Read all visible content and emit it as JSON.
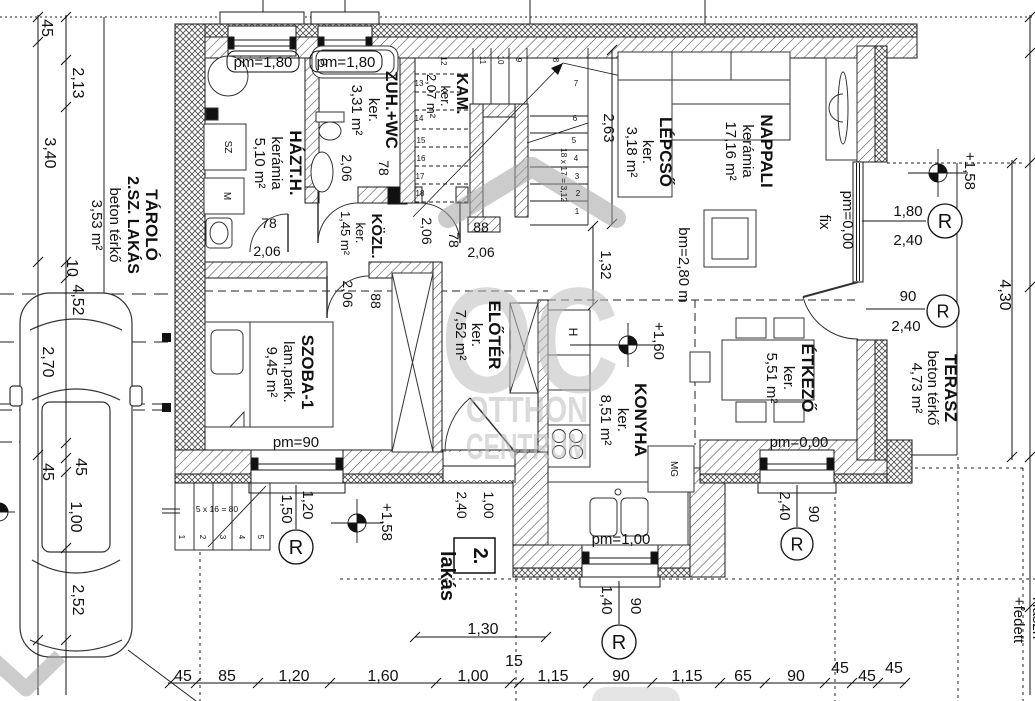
{
  "meta": {
    "drawing_type": "floor-plan",
    "unit_tag": "2. lakás",
    "background": "#ffffff",
    "line_color": "#111111",
    "watermark_color": "#bdbdbd"
  },
  "watermark": {
    "letters": "OC",
    "line1": "OTTHON",
    "line2": "CENTRUM"
  },
  "rooms": [
    {
      "name": "TÁROLÓ 2.SZ. LAKÁS",
      "finish": "beton térkő",
      "area": "3,53 m²"
    },
    {
      "name": "HÁZT.H.",
      "finish": "kerámia",
      "area": "5,10 m²"
    },
    {
      "name": "ZUH.+WC",
      "finish": "ker.",
      "area": "3,31 m²"
    },
    {
      "name": "KAM.",
      "finish": "ker.",
      "area": "2,07 m²"
    },
    {
      "name": "LÉPCSŐ",
      "finish": "ker.",
      "area": "3,18 m²"
    },
    {
      "name": "NAPPALI",
      "finish": "kerámia",
      "area": "17,16 m²"
    },
    {
      "name": "KÖZL.",
      "finish": "ker.",
      "area": "1,45 m²"
    },
    {
      "name": "SZOBA-1",
      "finish": "lam.park.",
      "area": "9,45 m²"
    },
    {
      "name": "ELŐTÉR",
      "finish": "ker.",
      "area": "7,52 m²"
    },
    {
      "name": "KONYHA",
      "finish": "ker.",
      "area": "8,51 m²"
    },
    {
      "name": "ÉTKEZŐ",
      "finish": "ker.",
      "area": "5,51 m²"
    },
    {
      "name": "TERASZ",
      "finish": "beton térkő",
      "area": "4,73 m²"
    }
  ],
  "r_letter": "R",
  "r_markers": [
    {
      "x": 945,
      "y": 221,
      "rad": 17
    },
    {
      "x": 943,
      "y": 311,
      "rad": 16
    },
    {
      "x": 296,
      "y": 547,
      "rad": 17
    },
    {
      "x": 619,
      "y": 642,
      "rad": 17
    },
    {
      "x": 797,
      "y": 544,
      "rad": 16
    }
  ],
  "elev_markers": [
    {
      "x": 938,
      "y": 173,
      "h1": 30,
      "h2": 30,
      "v1": 24,
      "v2": 24
    },
    {
      "x": 357,
      "y": 523,
      "h1": 26,
      "h2": 26,
      "v1": 24,
      "v2": 20
    },
    {
      "x": 628,
      "y": 345,
      "h1": 58,
      "h2": 28,
      "v1": 22,
      "v2": 22
    },
    {
      "x": -1,
      "y": 512,
      "h1": 0,
      "h2": 16,
      "v1": 12,
      "v2": 12
    }
  ],
  "labels": [
    {
      "t": "TÁROLÓ",
      "x": 146,
      "y": 225,
      "r": 90,
      "s": 17,
      "b": 1,
      "n": "room-label-tarolo"
    },
    {
      "t": "2.SZ. LAKÁS",
      "x": 128,
      "y": 225,
      "r": 90,
      "s": 16,
      "b": 1
    },
    {
      "t": "beton térkő",
      "x": 110,
      "y": 225,
      "r": 90,
      "s": 15
    },
    {
      "t": "3,53 m²",
      "x": 92,
      "y": 225,
      "r": 90,
      "s": 15
    },
    {
      "t": "HÁZT.H.",
      "x": 290,
      "y": 163,
      "r": 90,
      "s": 17,
      "b": 1,
      "n": "room-label-hazth"
    },
    {
      "t": "kerámia",
      "x": 272,
      "y": 163,
      "r": 90,
      "s": 15
    },
    {
      "t": "5,10 m²",
      "x": 255,
      "y": 163,
      "r": 90,
      "s": 15
    },
    {
      "t": "ZUH.+WC",
      "x": 386,
      "y": 110,
      "r": 90,
      "s": 17,
      "b": 1,
      "n": "room-label-zuhwc"
    },
    {
      "t": "ker.",
      "x": 369,
      "y": 110,
      "r": 90,
      "s": 15
    },
    {
      "t": "3,31 m²",
      "x": 352,
      "y": 110,
      "r": 90,
      "s": 15
    },
    {
      "t": "KAM.",
      "x": 457,
      "y": 94,
      "r": 90,
      "s": 16,
      "b": 1,
      "n": "room-label-kam"
    },
    {
      "t": "ker.",
      "x": 441,
      "y": 96,
      "r": 90,
      "s": 13
    },
    {
      "t": "2,07 m²",
      "x": 427,
      "y": 96,
      "r": 90,
      "s": 13
    },
    {
      "t": "LÉPCSŐ",
      "x": 660,
      "y": 152,
      "r": 90,
      "s": 17,
      "b": 1,
      "n": "room-label-lepcso"
    },
    {
      "t": "ker.",
      "x": 643,
      "y": 152,
      "r": 90,
      "s": 15
    },
    {
      "t": "3,18 m²",
      "x": 627,
      "y": 152,
      "r": 90,
      "s": 15
    },
    {
      "t": "NAPPALI",
      "x": 761,
      "y": 151,
      "r": 90,
      "s": 17,
      "b": 1,
      "n": "room-label-nappali"
    },
    {
      "t": "kerámia",
      "x": 743,
      "y": 151,
      "r": 90,
      "s": 15
    },
    {
      "t": "17,16 m²",
      "x": 726,
      "y": 151,
      "r": 90,
      "s": 15
    },
    {
      "t": "KÖZL.",
      "x": 372,
      "y": 236,
      "r": 90,
      "s": 15,
      "b": 1,
      "n": "room-label-kozl"
    },
    {
      "t": "ker.",
      "x": 356,
      "y": 233,
      "r": 90,
      "s": 13
    },
    {
      "t": "1,45 m²",
      "x": 341,
      "y": 233,
      "r": 90,
      "s": 13
    },
    {
      "t": "SZOBA-1",
      "x": 302,
      "y": 372,
      "r": 90,
      "s": 17,
      "b": 1,
      "n": "room-label-szoba1"
    },
    {
      "t": "lam.park.",
      "x": 284,
      "y": 372,
      "r": 90,
      "s": 15
    },
    {
      "t": "9,45 m²",
      "x": 267,
      "y": 372,
      "r": 90,
      "s": 15
    },
    {
      "t": "ELŐTÉR",
      "x": 489,
      "y": 335,
      "r": 90,
      "s": 17,
      "b": 1,
      "n": "room-label-eloter"
    },
    {
      "t": "ker.",
      "x": 472,
      "y": 335,
      "r": 90,
      "s": 15
    },
    {
      "t": "7,52 m²",
      "x": 456,
      "y": 335,
      "r": 90,
      "s": 15
    },
    {
      "t": "KONYHA",
      "x": 635,
      "y": 420,
      "r": 90,
      "s": 17,
      "b": 1,
      "n": "room-label-konyha"
    },
    {
      "t": "ker.",
      "x": 618,
      "y": 420,
      "r": 90,
      "s": 15
    },
    {
      "t": "8,51 m²",
      "x": 601,
      "y": 420,
      "r": 90,
      "s": 15
    },
    {
      "t": "ÉTKEZŐ",
      "x": 802,
      "y": 378,
      "r": 90,
      "s": 17,
      "b": 1,
      "n": "room-label-etkezo"
    },
    {
      "t": "ker.",
      "x": 784,
      "y": 378,
      "r": 90,
      "s": 15
    },
    {
      "t": "5,51 m²",
      "x": 767,
      "y": 378,
      "r": 90,
      "s": 15
    },
    {
      "t": "TERASZ",
      "x": 945,
      "y": 388,
      "r": 90,
      "s": 17,
      "b": 1,
      "n": "room-label-terasz"
    },
    {
      "t": "beton térkő",
      "x": 928,
      "y": 388,
      "r": 90,
      "s": 15
    },
    {
      "t": "4,73 m²",
      "x": 912,
      "y": 388,
      "r": 90,
      "s": 15
    },
    {
      "t": "pm=1,80",
      "x": 263,
      "y": 67,
      "s": 15,
      "n": "pm-label"
    },
    {
      "t": "pm=1,80",
      "x": 346,
      "y": 67,
      "s": 15,
      "n": "pm-label"
    },
    {
      "t": "pm=90",
      "x": 296,
      "y": 447,
      "s": 15,
      "n": "pm-label"
    },
    {
      "t": "pm=0,00",
      "x": 799,
      "y": 447,
      "s": 15,
      "n": "pm-label"
    },
    {
      "t": "pm=1,00",
      "x": 621,
      "y": 544,
      "s": 15,
      "n": "pm-label"
    },
    {
      "t": "pm=0,00",
      "x": 843,
      "y": 220,
      "r": 90,
      "s": 15,
      "n": "pm-label"
    },
    {
      "t": "fix",
      "x": 820,
      "y": 222,
      "r": 90,
      "s": 15
    },
    {
      "t": "bm=2,80 m",
      "x": 679,
      "y": 265,
      "r": 90,
      "s": 15
    },
    {
      "t": "+1,58",
      "x": 965,
      "y": 171,
      "r": 90,
      "s": 15,
      "n": "elevation-value"
    },
    {
      "t": "+1,58",
      "x": 382,
      "y": 522,
      "r": 90,
      "s": 15,
      "n": "elevation-value"
    },
    {
      "t": "+1,60",
      "x": 654,
      "y": 341,
      "r": 90,
      "s": 15,
      "n": "elevation-value"
    },
    {
      "t": "1,80",
      "x": 908,
      "y": 216,
      "s": 15
    },
    {
      "t": "2,40",
      "x": 908,
      "y": 245,
      "s": 15
    },
    {
      "t": "90",
      "x": 908,
      "y": 301,
      "s": 15
    },
    {
      "t": "2,40",
      "x": 906,
      "y": 331,
      "s": 15
    },
    {
      "t": "1,20",
      "x": 303,
      "y": 505,
      "r": 90,
      "s": 15
    },
    {
      "t": "1,50",
      "x": 282,
      "y": 509,
      "r": 90,
      "s": 15
    },
    {
      "t": "1,40",
      "x": 602,
      "y": 600,
      "r": 90,
      "s": 15
    },
    {
      "t": "90",
      "x": 631,
      "y": 606,
      "r": 90,
      "s": 15
    },
    {
      "t": "2,40",
      "x": 780,
      "y": 506,
      "r": 90,
      "s": 15
    },
    {
      "t": "90",
      "x": 809,
      "y": 514,
      "r": 90,
      "s": 15
    },
    {
      "t": "78",
      "x": 269,
      "y": 228,
      "s": 14
    },
    {
      "t": "2,06",
      "x": 267,
      "y": 256,
      "s": 14
    },
    {
      "t": "2,06",
      "x": 342,
      "y": 168,
      "r": 90,
      "s": 14
    },
    {
      "t": "78",
      "x": 379,
      "y": 168,
      "r": 90,
      "s": 14
    },
    {
      "t": "2,06",
      "x": 422,
      "y": 231,
      "r": 90,
      "s": 14
    },
    {
      "t": "78",
      "x": 449,
      "y": 240,
      "r": 90,
      "s": 14
    },
    {
      "t": "88",
      "x": 481,
      "y": 232,
      "s": 14
    },
    {
      "t": "2,06",
      "x": 481,
      "y": 257,
      "s": 14
    },
    {
      "t": "2,06",
      "x": 343,
      "y": 294,
      "r": 90,
      "s": 14
    },
    {
      "t": "88",
      "x": 371,
      "y": 301,
      "r": 90,
      "s": 14
    },
    {
      "t": "2,40",
      "x": 457,
      "y": 505,
      "r": 90,
      "s": 14
    },
    {
      "t": "1,00",
      "x": 484,
      "y": 505,
      "r": 90,
      "s": 14
    },
    {
      "t": "1,32",
      "x": 601,
      "y": 265,
      "r": 90,
      "s": 15
    },
    {
      "t": "2,63",
      "x": 604,
      "y": 128,
      "r": 90,
      "s": 15
    },
    {
      "t": "18 x 17 = 3,12",
      "x": 561,
      "y": 175,
      "r": 90,
      "s": 8.5
    },
    {
      "t": "5 x 16 = 80",
      "x": 217,
      "y": 512,
      "s": 8.5
    },
    {
      "t": "1",
      "x": 577,
      "y": 214,
      "s": 8,
      "n": "stair-step-number"
    },
    {
      "t": "2",
      "x": 578,
      "y": 196,
      "s": 8,
      "n": "stair-step-number"
    },
    {
      "t": "3",
      "x": 577,
      "y": 179,
      "s": 8,
      "n": "stair-step-number"
    },
    {
      "t": "4",
      "x": 576,
      "y": 161,
      "s": 8,
      "n": "stair-step-number"
    },
    {
      "t": "5",
      "x": 574,
      "y": 143,
      "s": 8,
      "n": "stair-step-number"
    },
    {
      "t": "6",
      "x": 575,
      "y": 121,
      "s": 8,
      "n": "stair-step-number"
    },
    {
      "t": "7",
      "x": 576,
      "y": 86,
      "s": 8,
      "n": "stair-step-number"
    },
    {
      "t": "8",
      "x": 553,
      "y": 60,
      "r": 90,
      "s": 8,
      "n": "stair-step-number"
    },
    {
      "t": "9",
      "x": 516,
      "y": 60,
      "r": 90,
      "s": 8,
      "n": "stair-step-number"
    },
    {
      "t": "10",
      "x": 498,
      "y": 60,
      "r": 90,
      "s": 8,
      "n": "stair-step-number"
    },
    {
      "t": "11",
      "x": 480,
      "y": 60,
      "r": 90,
      "s": 8,
      "n": "stair-step-number"
    },
    {
      "t": "12",
      "x": 441,
      "y": 61,
      "r": 90,
      "s": 8,
      "n": "stair-step-number"
    },
    {
      "t": "13",
      "x": 419,
      "y": 86,
      "s": 8,
      "n": "stair-step-number"
    },
    {
      "t": "14",
      "x": 419,
      "y": 121,
      "s": 8,
      "n": "stair-step-number"
    },
    {
      "t": "15",
      "x": 421,
      "y": 143,
      "s": 8,
      "n": "stair-step-number"
    },
    {
      "t": "16",
      "x": 421,
      "y": 161,
      "s": 8,
      "n": "stair-step-number"
    },
    {
      "t": "17",
      "x": 420,
      "y": 179,
      "s": 8,
      "n": "stair-step-number"
    },
    {
      "t": "18",
      "x": 420,
      "y": 196,
      "s": 8,
      "n": "stair-step-number"
    },
    {
      "t": "1",
      "x": 179,
      "y": 537,
      "r": 90,
      "s": 8,
      "n": "ext-step-number"
    },
    {
      "t": "2",
      "x": 200,
      "y": 537,
      "r": 90,
      "s": 8,
      "n": "ext-step-number"
    },
    {
      "t": "3",
      "x": 220,
      "y": 537,
      "r": 90,
      "s": 8,
      "n": "ext-step-number"
    },
    {
      "t": "4",
      "x": 239,
      "y": 537,
      "r": 90,
      "s": 8,
      "n": "ext-step-number"
    },
    {
      "t": "5",
      "x": 258,
      "y": 537,
      "r": 90,
      "s": 8,
      "n": "ext-step-number"
    },
    {
      "t": "2.",
      "x": 474,
      "y": 556,
      "r": 90,
      "s": 20,
      "b": 1,
      "n": "unit-number"
    },
    {
      "t": "lakás",
      "x": 441,
      "y": 576,
      "r": 90,
      "s": 20,
      "b": 1,
      "n": "unit-label"
    },
    {
      "t": "H",
      "x": 569,
      "y": 332,
      "r": 90,
      "s": 12,
      "n": "appliance-letter"
    },
    {
      "t": "SZ",
      "x": 225,
      "y": 147,
      "r": 90,
      "s": 10,
      "n": "appliance-letter"
    },
    {
      "t": "M",
      "x": 224,
      "y": 196,
      "r": 90,
      "s": 10,
      "n": "appliance-letter"
    },
    {
      "t": "MG",
      "x": 671,
      "y": 469,
      "r": 90,
      "s": 10,
      "n": "appliance-letter"
    },
    {
      "t": "45",
      "x": 183,
      "y": 681,
      "s": 16,
      "n": "dim-bottom"
    },
    {
      "t": "85",
      "x": 227,
      "y": 681,
      "s": 16,
      "n": "dim-bottom"
    },
    {
      "t": "1,20",
      "x": 294,
      "y": 681,
      "s": 16,
      "n": "dim-bottom"
    },
    {
      "t": "1,60",
      "x": 383,
      "y": 681,
      "s": 16,
      "n": "dim-bottom"
    },
    {
      "t": "1,00",
      "x": 473,
      "y": 681,
      "s": 16,
      "n": "dim-bottom"
    },
    {
      "t": "15",
      "x": 514,
      "y": 666,
      "s": 16,
      "n": "dim-bottom"
    },
    {
      "t": "1,15",
      "x": 553,
      "y": 681,
      "s": 16,
      "n": "dim-bottom"
    },
    {
      "t": "90",
      "x": 621,
      "y": 681,
      "s": 16,
      "n": "dim-bottom"
    },
    {
      "t": "1,15",
      "x": 687,
      "y": 681,
      "s": 16,
      "n": "dim-bottom"
    },
    {
      "t": "65",
      "x": 743,
      "y": 681,
      "s": 16,
      "n": "dim-bottom"
    },
    {
      "t": "90",
      "x": 796,
      "y": 681,
      "s": 16,
      "n": "dim-bottom"
    },
    {
      "t": "45",
      "x": 840,
      "y": 673,
      "s": 16,
      "n": "dim-bottom"
    },
    {
      "t": "45",
      "x": 867,
      "y": 681,
      "s": 16,
      "n": "dim-bottom"
    },
    {
      "t": "45",
      "x": 894,
      "y": 673,
      "s": 16,
      "n": "dim-bottom"
    },
    {
      "t": "1,30",
      "x": 483,
      "y": 634,
      "s": 16,
      "n": "dim-bottom"
    },
    {
      "t": "5,85",
      "x": 345,
      "y": 712,
      "s": 16,
      "n": "dim-bottom"
    },
    {
      "t": "45",
      "x": 42,
      "y": 28,
      "r": 90,
      "s": 16,
      "n": "dim-left"
    },
    {
      "t": "2,13",
      "x": 73,
      "y": 83,
      "r": 90,
      "s": 16,
      "n": "dim-left"
    },
    {
      "t": "3,40",
      "x": 45,
      "y": 153,
      "r": 90,
      "s": 16,
      "n": "dim-left"
    },
    {
      "t": "10",
      "x": 67,
      "y": 268,
      "r": 90,
      "s": 16,
      "n": "dim-left"
    },
    {
      "t": "4,52",
      "x": 73,
      "y": 300,
      "r": 90,
      "s": 16,
      "n": "dim-left"
    },
    {
      "t": "2,70",
      "x": 43,
      "y": 362,
      "r": 90,
      "s": 16,
      "n": "dim-left"
    },
    {
      "t": "45",
      "x": 76,
      "y": 467,
      "r": 90,
      "s": 16,
      "n": "dim-left"
    },
    {
      "t": "45",
      "x": 43,
      "y": 472,
      "r": 90,
      "s": 16,
      "n": "dim-left"
    },
    {
      "t": "1,00",
      "x": 71,
      "y": 517,
      "r": 90,
      "s": 16,
      "n": "dim-left"
    },
    {
      "t": "2,52",
      "x": 73,
      "y": 600,
      "r": 90,
      "s": 16,
      "n": "dim-left"
    },
    {
      "t": "4,30",
      "x": 1000,
      "y": 295,
      "r": 90,
      "s": 16,
      "n": "dim-right"
    },
    {
      "t": "+fedett",
      "x": 1014,
      "y": 620,
      "r": 90,
      "s": 15,
      "n": "dim-right"
    },
    {
      "t": "Haszn",
      "x": 1033,
      "y": 618,
      "r": 90,
      "s": 15,
      "n": "dim-right"
    }
  ]
}
